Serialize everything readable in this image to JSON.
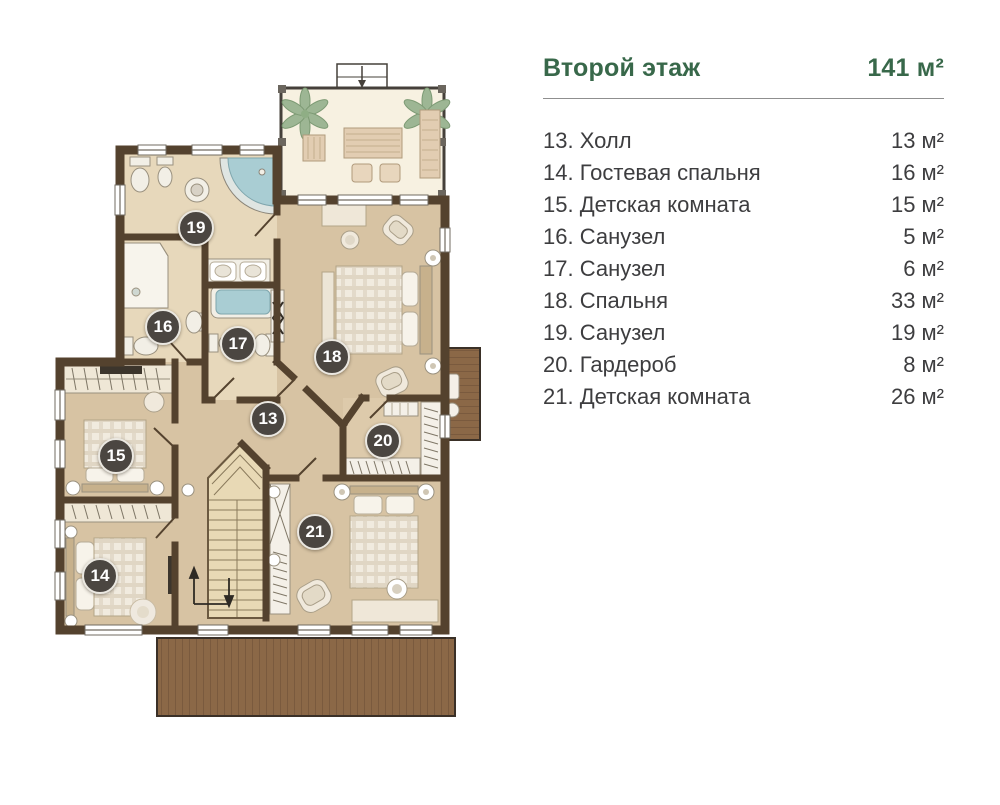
{
  "legend": {
    "title": "Второй этаж",
    "total_area": "141 м²",
    "accent_color": "#38684a",
    "items": [
      {
        "label": "13. Холл",
        "area": "13 м²"
      },
      {
        "label": "14. Гостевая спальня",
        "area": "16 м²"
      },
      {
        "label": "15. Детская комната",
        "area": "15 м²"
      },
      {
        "label": "16. Санузел",
        "area": "5 м²"
      },
      {
        "label": "17. Санузел",
        "area": "6 м²"
      },
      {
        "label": "18. Спальня",
        "area": "33 м²"
      },
      {
        "label": "19. Санузел",
        "area": "19 м²"
      },
      {
        "label": "20. Гардероб",
        "area": "8 м²"
      },
      {
        "label": "21. Детская комната",
        "area": "26 м²"
      }
    ]
  },
  "plan": {
    "badge_color": "#4b4641",
    "wall_color": "#54422e",
    "floor_color": "#d7c3a3",
    "badges": [
      {
        "number": "19"
      },
      {
        "number": "16"
      },
      {
        "number": "17"
      },
      {
        "number": "18"
      },
      {
        "number": "13"
      },
      {
        "number": "20"
      },
      {
        "number": "15"
      },
      {
        "number": "21"
      },
      {
        "number": "14"
      }
    ]
  }
}
